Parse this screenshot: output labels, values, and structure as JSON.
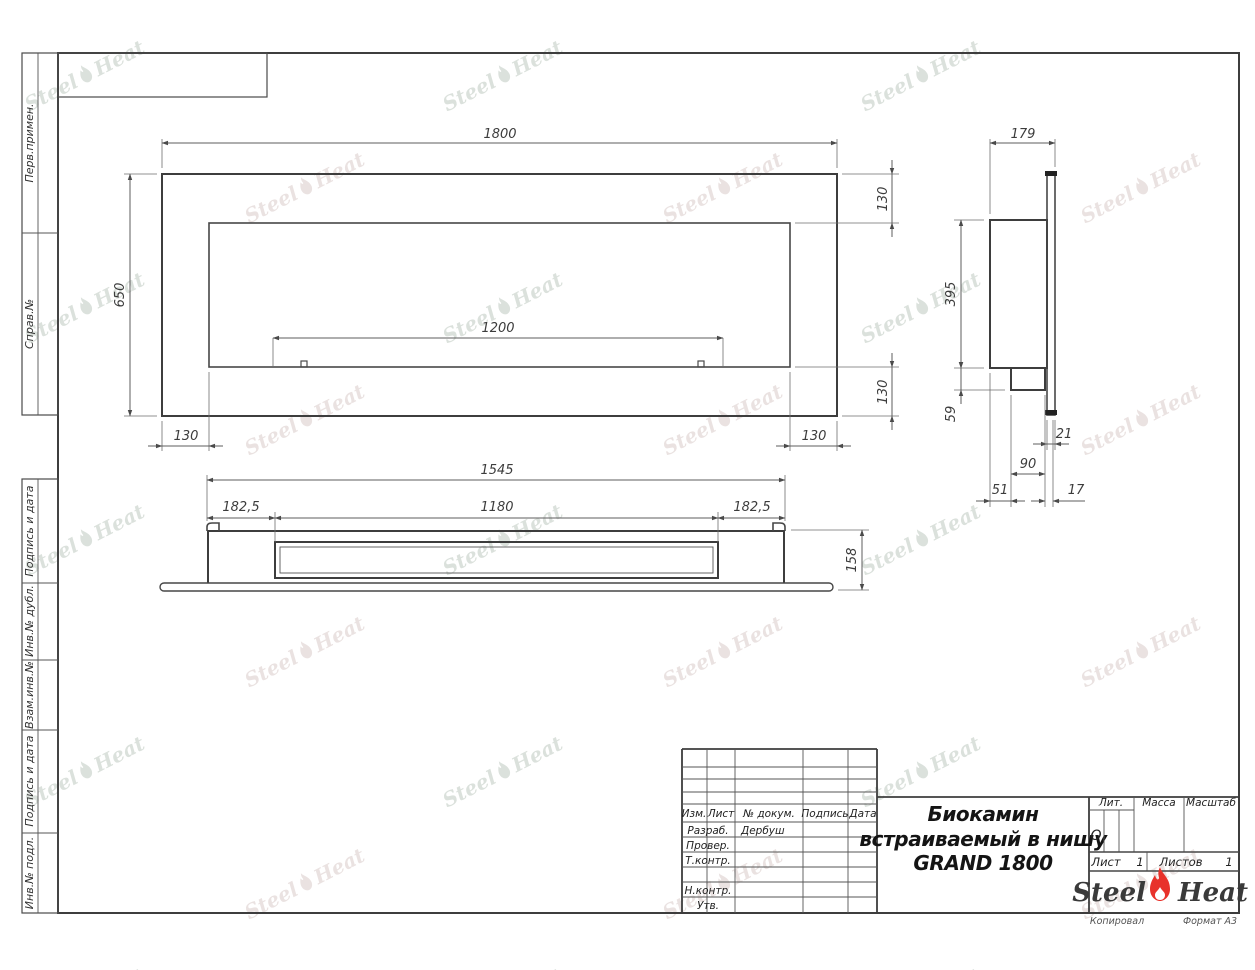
{
  "sheet": {
    "copied_label": "Копировал",
    "format_label": "Формат А3"
  },
  "inventory_strip": {
    "labels": [
      "Перв.примен.",
      "Справ.№",
      "Подпись и дата",
      "Инв.№ дубл.",
      "Взам.инв.№",
      "Подпись и дата",
      "Инв.№ подл."
    ]
  },
  "title_block": {
    "header_columns": [
      "Изм.",
      "Лист",
      "№ докум.",
      "Подпись",
      "Дата"
    ],
    "rows": [
      {
        "label": "Разраб.",
        "value": "Дербуш"
      },
      {
        "label": "Провер.",
        "value": ""
      },
      {
        "label": "Т.контр.",
        "value": ""
      },
      {
        "label": "Н.контр.",
        "value": ""
      },
      {
        "label": "Утв.",
        "value": ""
      }
    ],
    "title_line1": "Биокамин",
    "title_line2": "встраиваемый в нишу",
    "title_line3": "GRAND 1800",
    "lit_label": "Лит.",
    "lit_value": "О",
    "mass_label": "Масса",
    "scale_label": "Масштаб",
    "sheet_label": "Лист",
    "sheet_value": "1",
    "sheets_label": "Листов",
    "sheets_value": "1",
    "logo": {
      "part1": "Steel",
      "part2": "Heat",
      "flame_color": "#e8322b"
    }
  },
  "dimensions": {
    "front": {
      "width": "1800",
      "height": "650",
      "opening_width": "1200",
      "margin_left": "130",
      "margin_right": "130",
      "margin_top": "130",
      "margin_bottom": "130"
    },
    "side": {
      "depth": "179",
      "height": "395",
      "tray_depth": "59",
      "panel_thickness": "21",
      "tray_width": "90",
      "back_offset": "51",
      "gap": "17"
    },
    "bottom": {
      "body_width": "1545",
      "side_margin_left": "182,5",
      "burner_width": "1180",
      "side_margin_right": "182,5",
      "depth": "158"
    }
  },
  "watermark": {
    "part1": "Steel",
    "part2": "Heat"
  }
}
